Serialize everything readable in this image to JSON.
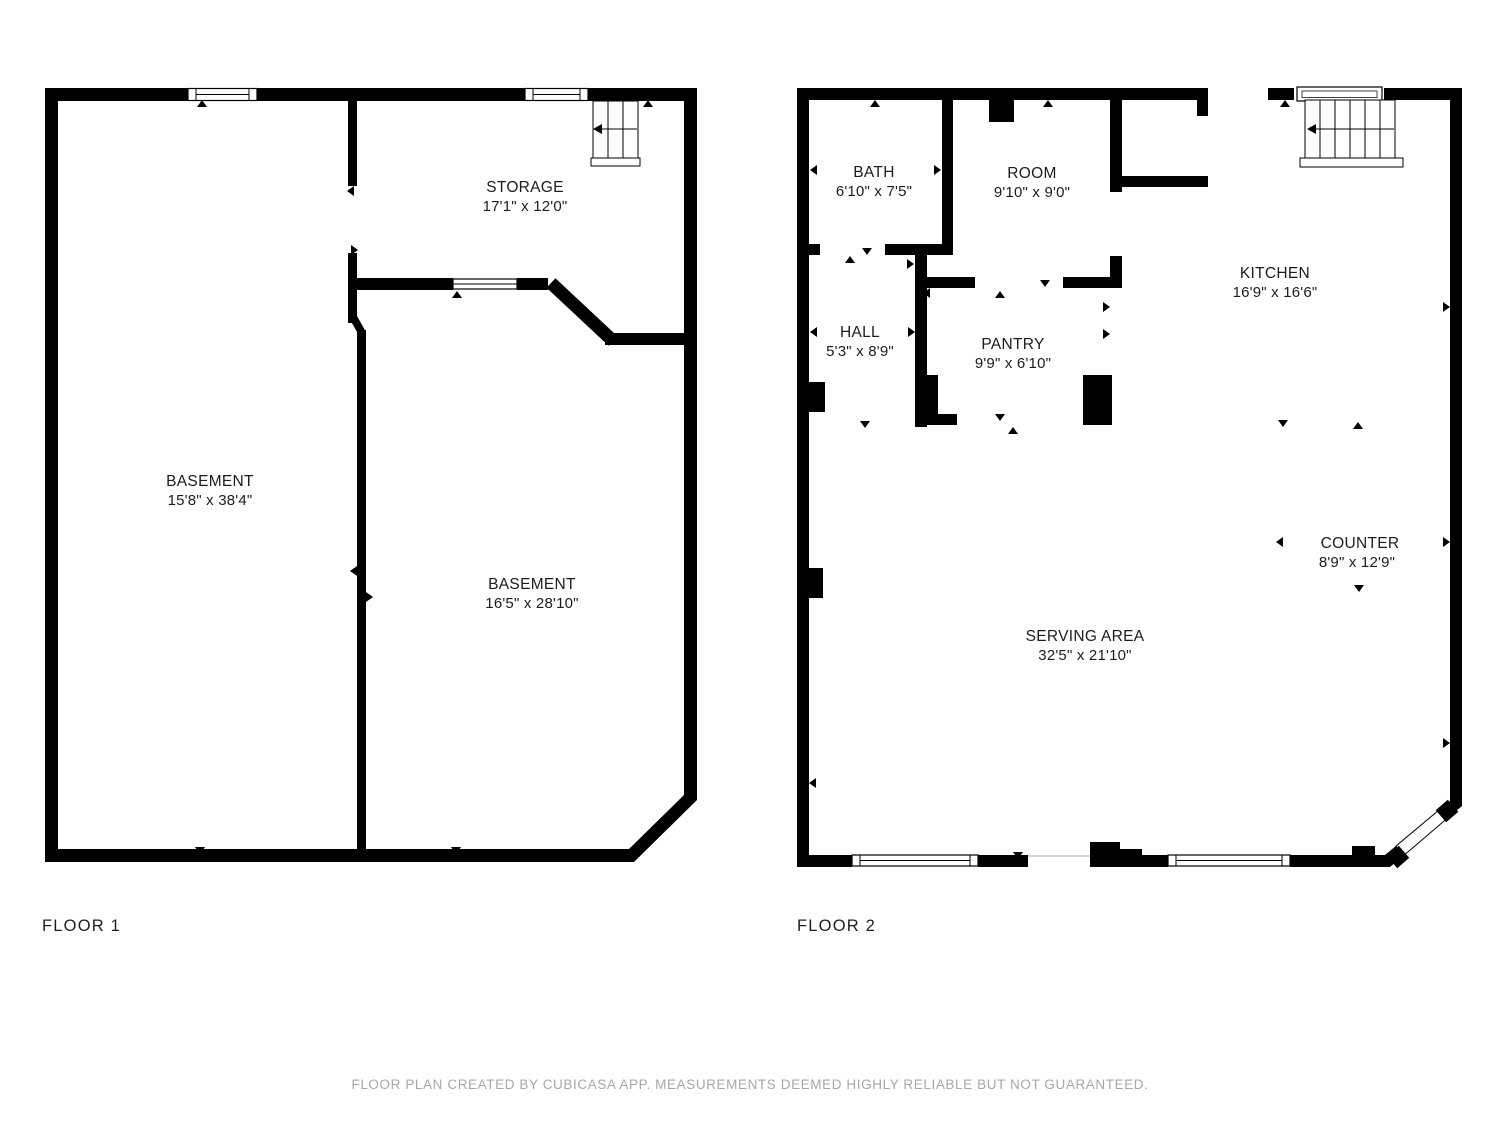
{
  "footer": {
    "text": "FLOOR PLAN CREATED BY CUBICASA APP. MEASUREMENTS DEEMED HIGHLY RELIABLE BUT NOT GUARANTEED."
  },
  "floor1": {
    "label": "FLOOR 1",
    "rooms": {
      "storage": {
        "name": "STORAGE",
        "dims": "17'1\" x 12'0\""
      },
      "basement_left": {
        "name": "BASEMENT",
        "dims": "15'8\" x 38'4\""
      },
      "basement_right": {
        "name": "BASEMENT",
        "dims": "16'5\" x 28'10\""
      }
    }
  },
  "floor2": {
    "label": "FLOOR 2",
    "rooms": {
      "bath": {
        "name": "BATH",
        "dims": "6'10\" x 7'5\""
      },
      "room": {
        "name": "ROOM",
        "dims": "9'10\" x 9'0\""
      },
      "kitchen": {
        "name": "KITCHEN",
        "dims": "16'9\" x 16'6\""
      },
      "hall": {
        "name": "HALL",
        "dims": "5'3\" x 8'9\""
      },
      "pantry": {
        "name": "PANTRY",
        "dims": "9'9\" x 6'10\""
      },
      "counter": {
        "name": "COUNTER",
        "dims": "8'9\" x 12'9\""
      },
      "serving_area": {
        "name": "SERVING AREA",
        "dims": "32'5\" x 21'10\""
      }
    }
  },
  "colors": {
    "wall": "#000000",
    "label_text": "#1c1c1c",
    "footer_text": "#a7a7a7"
  }
}
